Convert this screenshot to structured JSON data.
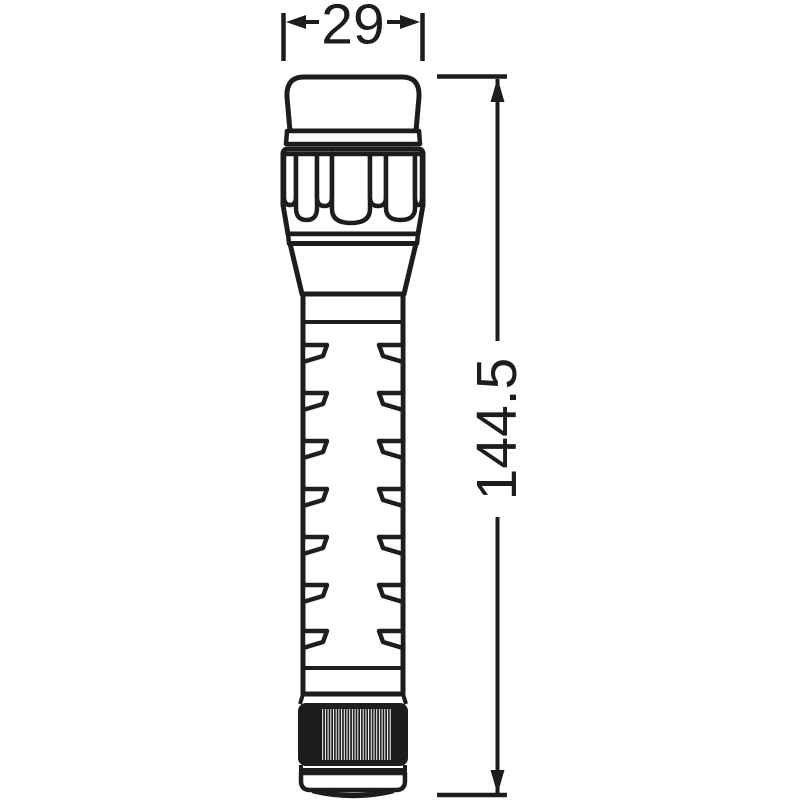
{
  "drawing": {
    "subject": "flashlight-side-view-technical-drawing",
    "line_color": "#1d1d1b",
    "background_color": "#ffffff"
  },
  "dimensions": {
    "width": {
      "label": "29",
      "orientation": "horizontal"
    },
    "height": {
      "label": "144.5",
      "orientation": "vertical"
    }
  }
}
